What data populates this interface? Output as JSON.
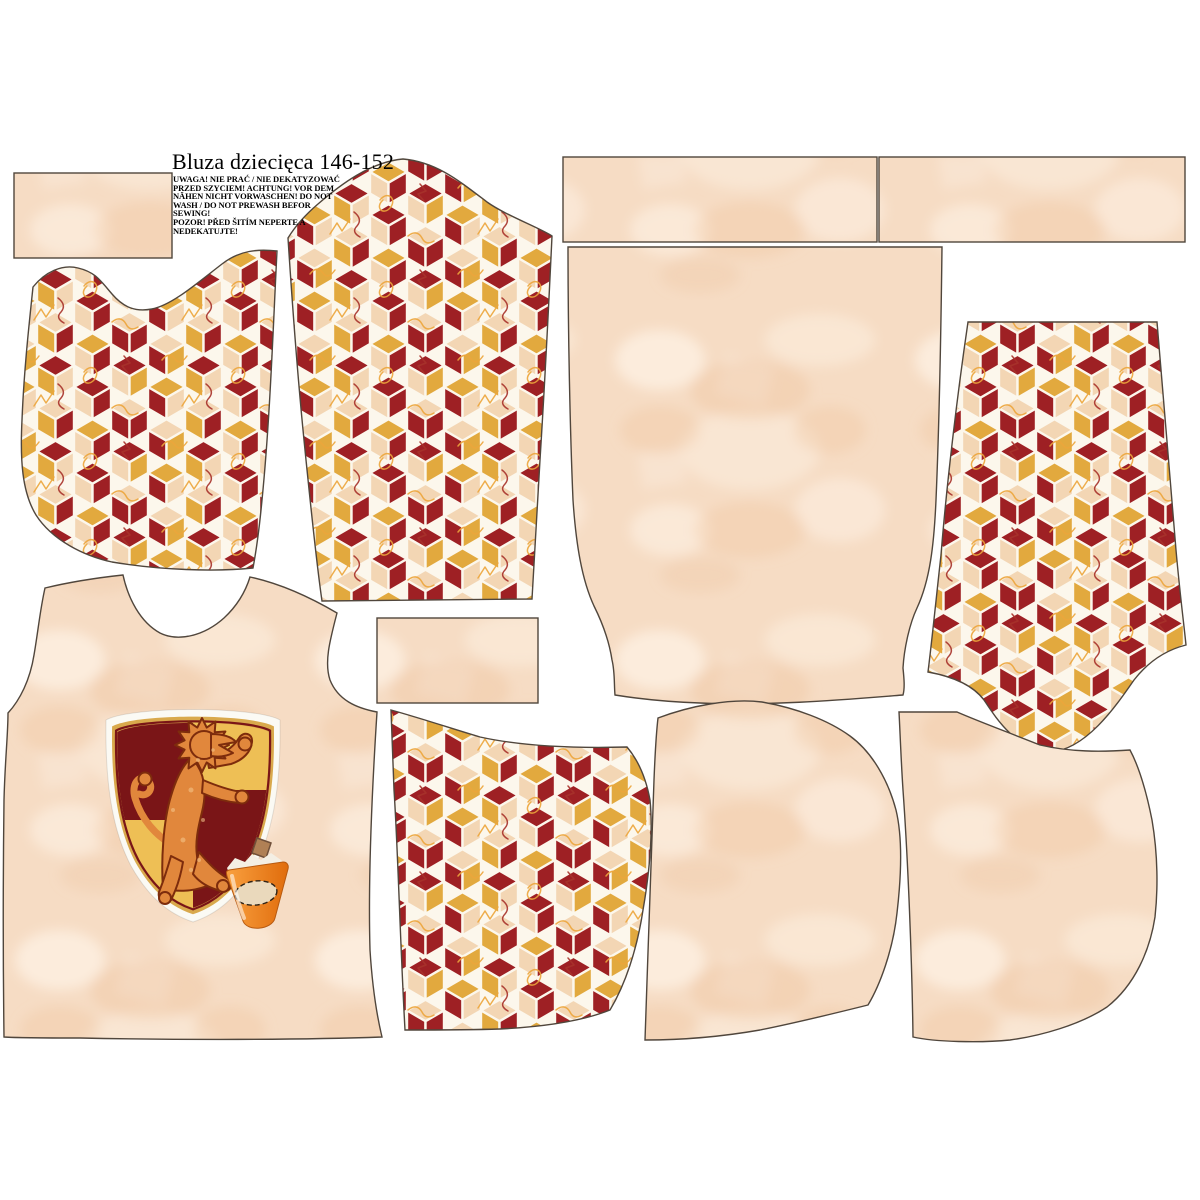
{
  "header": {
    "title": "Bluza dziecięca 146-152",
    "warning": "UWAGA! NIE PRAĆ / NIE DEKATYZOWAĆ\nPRZED SZYCIEM! ACHTUNG! VOR DEM\nNÄHEN NICHT VORWASCHEN! DO NOT\nWASH / DO NOT PREWASH BEFOR SEWING!\nPOZOR! PŘED ŠITÍM NEPERTE A\nNEDEKATUJTE!"
  },
  "colors": {
    "maroon": "#9e2024",
    "gold": "#e2a93e",
    "cubebeige": "#f3d6b4",
    "cubeborder": "#fcf7ec",
    "doodlegold": "#eda53b",
    "doodlered": "#a8322a",
    "beigebase": "#f6dcc4",
    "beigelight": "#fdf1e4",
    "beigedark": "#edbf97",
    "outline": "#50463c",
    "shieldwhite": "#fbfaf4",
    "shieldgold": "#d9a94c",
    "quartermaroon": "#7a1517",
    "quartergold": "#eebf55",
    "lion": "#e1873c",
    "lionoutline": "#7d2c0c",
    "lionspeck": "#f6c98e",
    "cuporange1": "#f9a03f",
    "cuporange2": "#e06c0c",
    "cupedge": "#b85a10",
    "cuprim": "#f4efe4",
    "cork": "#b08055",
    "corkedge": "#70503a",
    "cream": "#ead9bc"
  },
  "cube_pattern": {
    "faces": [
      [
        "b",
        "m",
        "g"
      ],
      [
        "m",
        "g",
        "b"
      ],
      [
        "g",
        "b",
        "m"
      ],
      [
        "m",
        "b",
        "g"
      ],
      [
        "g",
        "m",
        "b"
      ],
      [
        "b",
        "g",
        "m"
      ],
      [
        "m",
        "b",
        "m"
      ],
      [
        "b",
        "m",
        "m"
      ]
    ]
  },
  "pieces": [
    {
      "id": "rect-panel-left",
      "fabric": "plain-beige"
    },
    {
      "id": "body-half-cube-print",
      "fabric": "cube-print"
    },
    {
      "id": "sleeve-cube-print-top",
      "fabric": "cube-print"
    },
    {
      "id": "rect-panel-top-middle",
      "fabric": "plain-beige"
    },
    {
      "id": "rect-panel-top-right",
      "fabric": "plain-beige"
    },
    {
      "id": "back-body-plain",
      "fabric": "plain-beige"
    },
    {
      "id": "sleeve-cube-print-right",
      "fabric": "cube-print"
    },
    {
      "id": "front-body-with-crest",
      "fabric": "plain-beige"
    },
    {
      "id": "rect-panel-middle",
      "fabric": "plain-beige"
    },
    {
      "id": "hood-cube-print",
      "fabric": "cube-print"
    },
    {
      "id": "hood-plain-middle",
      "fabric": "plain-beige"
    },
    {
      "id": "hood-plain-right",
      "fabric": "plain-beige"
    }
  ]
}
